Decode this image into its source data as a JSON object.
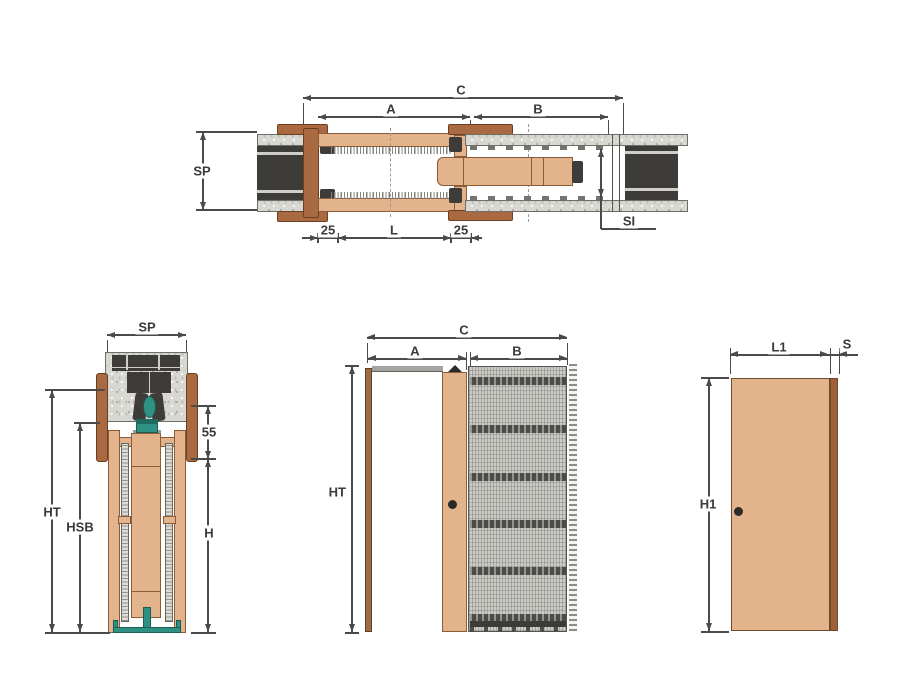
{
  "colors": {
    "line": "#4a4a4a",
    "text": "#3a3a3a",
    "tan": "#e3b38c",
    "brown": "#aa6a41",
    "dark": "#3e3c39",
    "teal": "#2f9183",
    "plaster": "#d8d7d2",
    "mesh": "#cccbc6",
    "band": "#4b4b47"
  },
  "views": {
    "plan": {
      "c": "C",
      "a": "A",
      "b": "B",
      "sp": "SP",
      "si": "SI",
      "off1": "25",
      "l": "L",
      "off2": "25"
    },
    "section": {
      "sp": "SP",
      "n55": "55",
      "ht": "HT",
      "hsb": "HSB",
      "h": "H"
    },
    "front": {
      "c": "C",
      "a": "A",
      "b": "B",
      "ht": "HT"
    },
    "door": {
      "l1": "L1",
      "s": "S",
      "h1": "H1"
    }
  }
}
